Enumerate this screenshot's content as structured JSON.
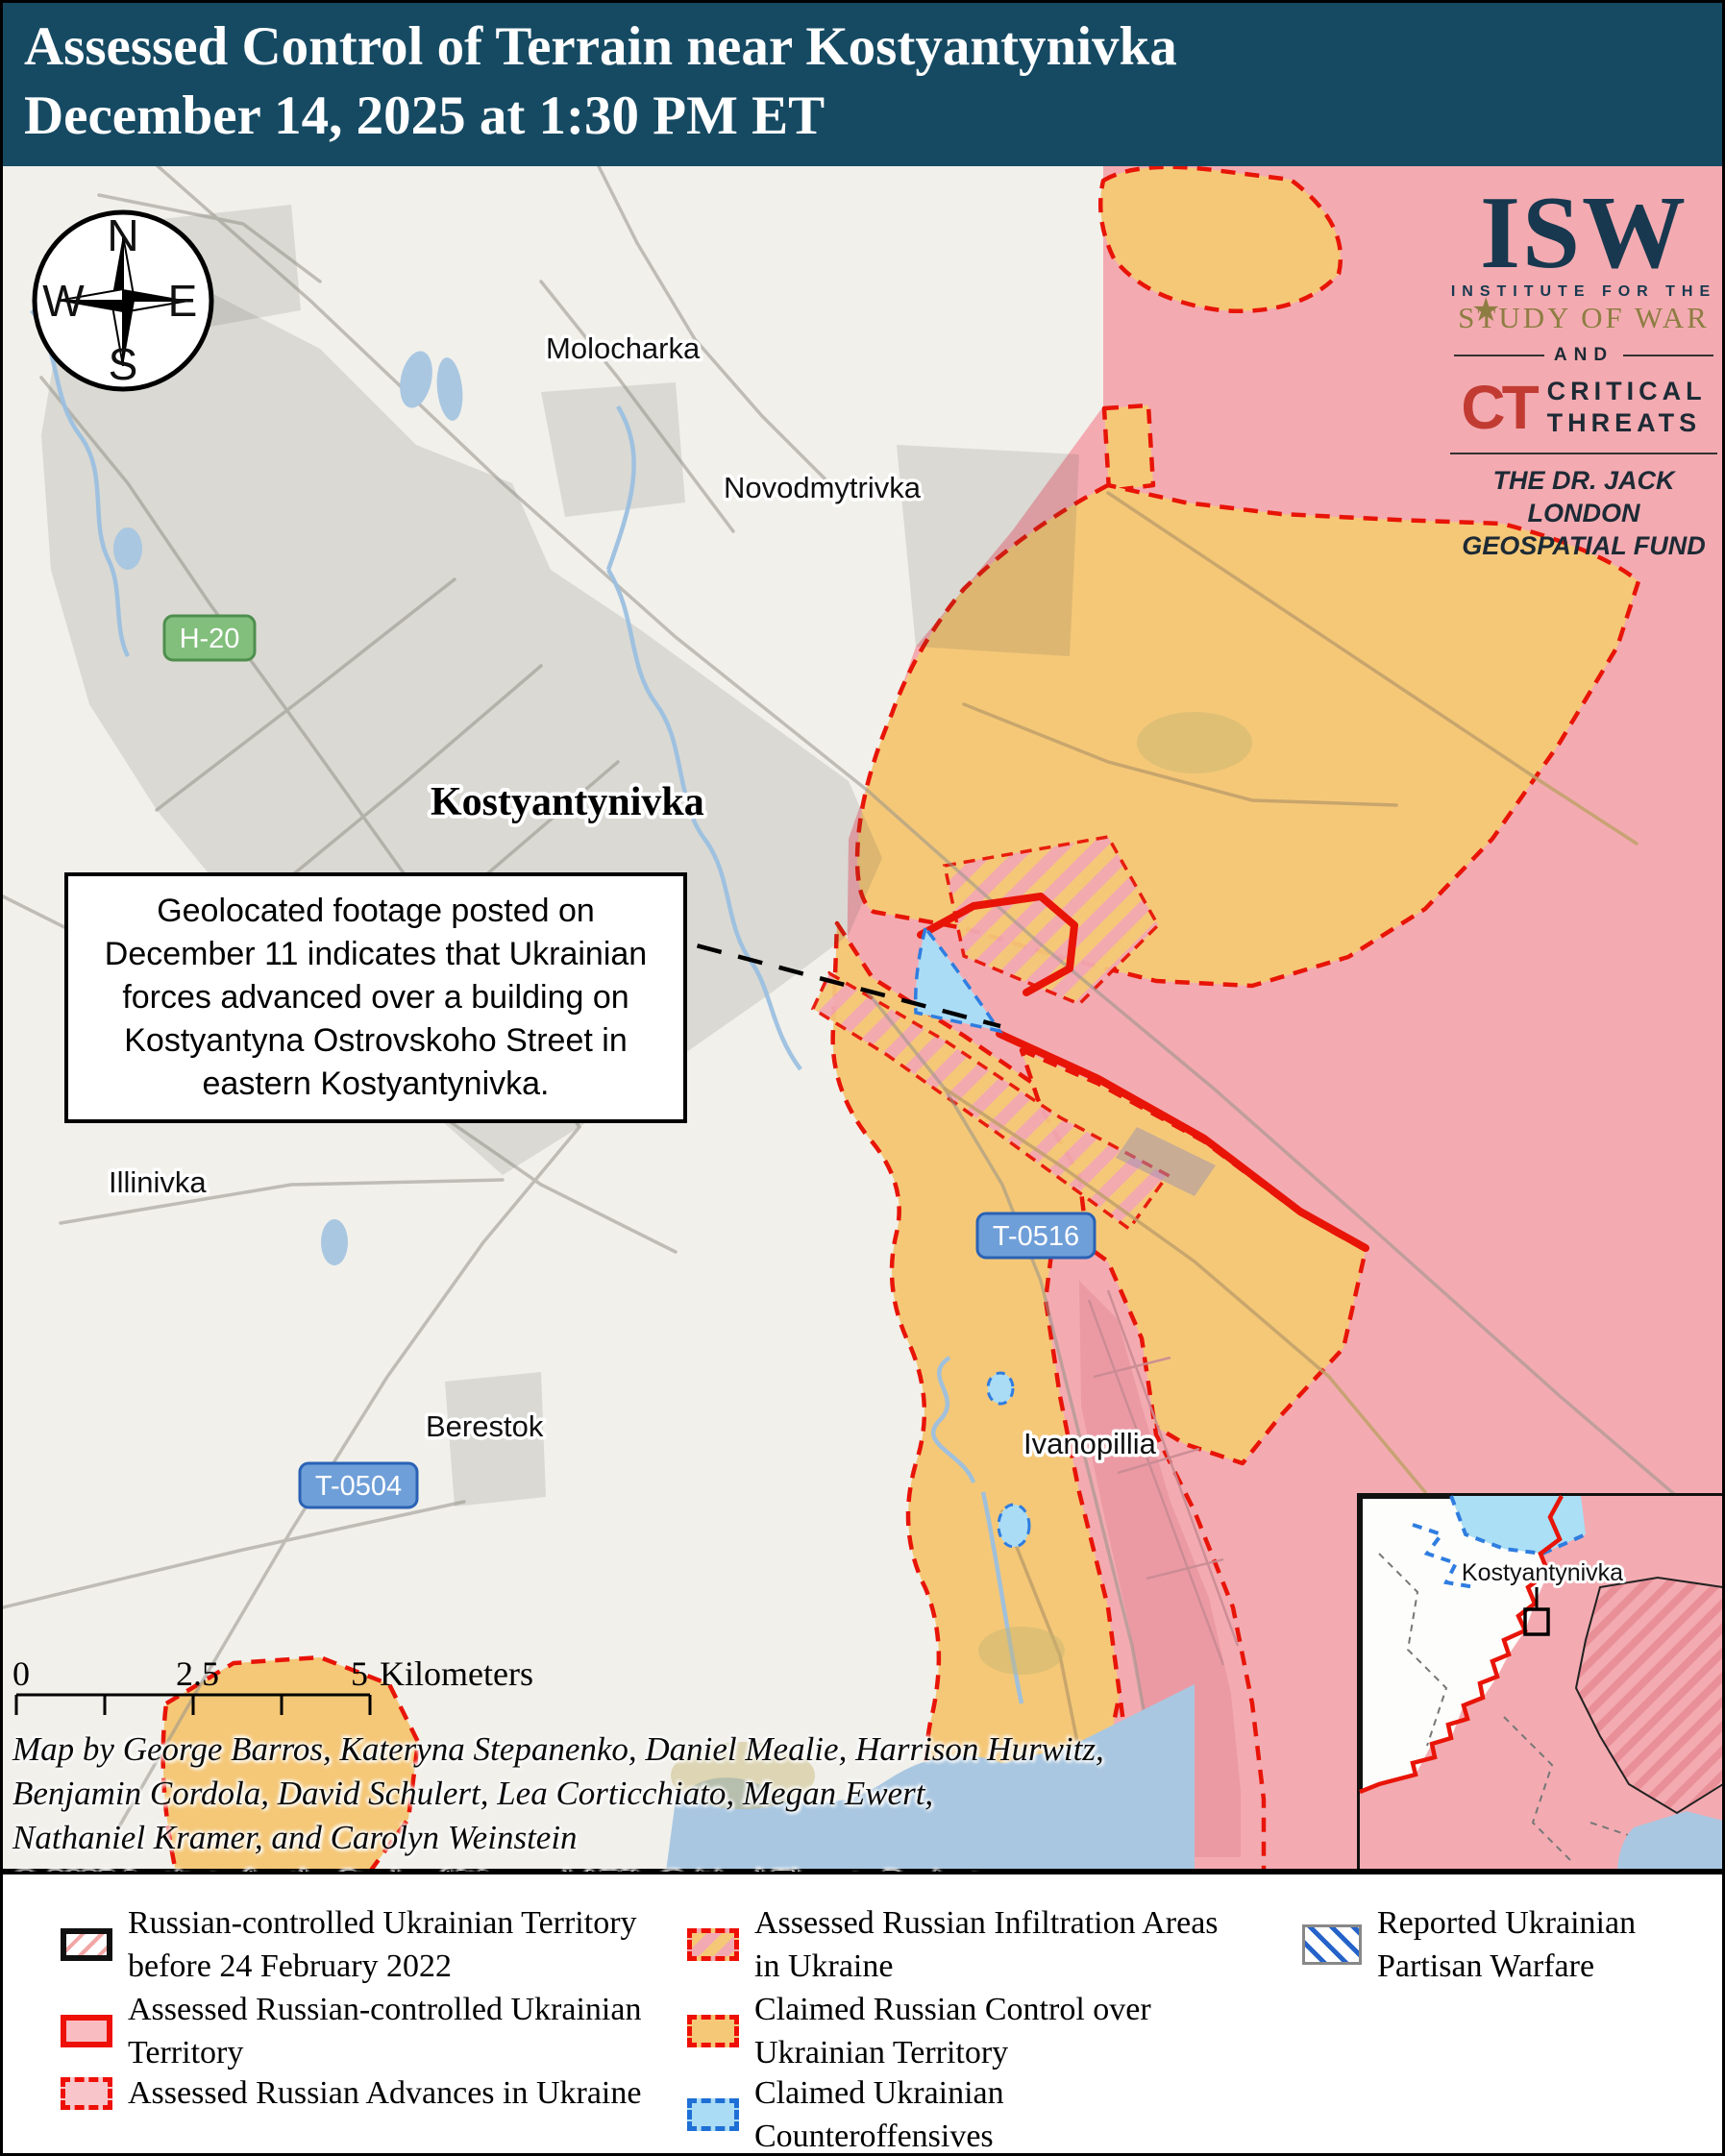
{
  "title": {
    "line1": "Assessed Control of Terrain near Kostyantynivka",
    "line2": "December 14, 2025 at 1:30 PM ET"
  },
  "logo": {
    "isw": "ISW",
    "institute": "INSTITUTE FOR THE",
    "study": "STUDY OF WAR",
    "star": "★",
    "and": "AND",
    "ct": "CT",
    "critical": "CRITICAL",
    "threats": "THREATS",
    "fund_line1": "THE DR. JACK LONDON",
    "fund_line2": "GEOSPATIAL FUND"
  },
  "compass": {
    "n": "N",
    "e": "E",
    "s": "S",
    "w": "W"
  },
  "places": {
    "molocharka": "Molocharka",
    "novodmytrivka": "Novodmytrivka",
    "kostyantynivka": "Kostyantynivka",
    "illinivka": "Illinivka",
    "berestok": "Berestok",
    "ivanopillia": "Ivanopillia"
  },
  "roads": {
    "h20": "H-20",
    "t0516": "T-0516",
    "t0504": "T-0504"
  },
  "annotation": "Geolocated footage posted on December 11 indicates that Ukrainian forces advanced over a building on Kostyantyna Ostrovskoho Street in eastern Kostyantynivka.",
  "scale": {
    "zero": "0",
    "mid": "2.5",
    "five": "5",
    "unit": "Kilometers"
  },
  "credits": {
    "line1": "Map by George Barros, Kateryna Stepanenko, Daniel Mealie, Harrison Hurwitz,",
    "line2": "Benjamin Cordola, David Schulert, Lea Corticchiato, Megan Ewert,",
    "line3": "Nathaniel Kramer, and Carolyn Weinstein",
    "line4": "© 2025 Institute for the Study of War and AEI's Critical Threats Project"
  },
  "inset": {
    "label": "Kostyantynivka"
  },
  "legend": {
    "items": [
      {
        "label": "Russian-controlled Ukrainian Territory before 24 February 2022",
        "swatch": "pre2022-hatch"
      },
      {
        "label": "Assessed Russian-controlled Ukrainian Territory",
        "swatch": "red-border-pink"
      },
      {
        "label": "Assessed Russian Advances in Ukraine",
        "swatch": "red-dash-pink"
      },
      {
        "label": "Assessed Russian Infiltration Areas in Ukraine",
        "swatch": "orange-pink-stripes"
      },
      {
        "label": "Claimed Russian Control over Ukrainian Territory",
        "swatch": "orange-red-dash"
      },
      {
        "label": "Claimed Ukrainian Counteroffensives",
        "swatch": "blue-dash-lightblue"
      },
      {
        "label": "Reported Ukrainian Partisan Warfare",
        "swatch": "blue-hatch"
      }
    ]
  },
  "colors": {
    "title_bar": "#164a63",
    "claimed_russian_orange": "#f5c878",
    "russian_advance_pink": "#f3abb1",
    "counteroffensive_blue": "#aadcf5",
    "frontline_red": "#e81408",
    "partisan_blue": "#2563c9",
    "water_blue": "#a9c7e1",
    "urban_gray": "#dedcd4",
    "background": "#f1f0eb"
  }
}
